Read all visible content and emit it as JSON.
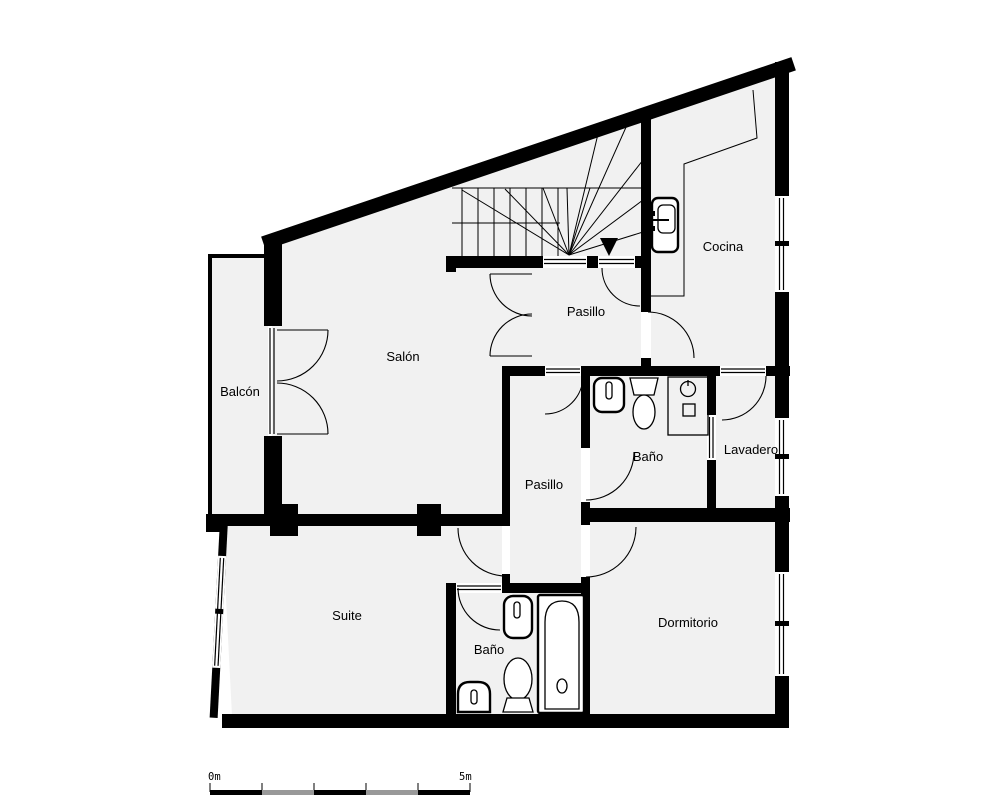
{
  "plan": {
    "rooms": {
      "balcon": {
        "label": "Balcón"
      },
      "salon": {
        "label": "Salón"
      },
      "pasillo_superior": {
        "label": "Pasillo"
      },
      "cocina": {
        "label": "Cocina"
      },
      "bano_principal": {
        "label": "Baño"
      },
      "lavadero": {
        "label": "Lavadero"
      },
      "pasillo_inferior": {
        "label": "Pasillo"
      },
      "suite": {
        "label": "Suite"
      },
      "bano_suite": {
        "label": "Baño"
      },
      "dormitorio": {
        "label": "Dormitorio"
      }
    },
    "scale_bar": {
      "start_label": "0m",
      "end_label": "5m"
    },
    "colors": {
      "wall": "#000000",
      "floor": "#f1f1f1",
      "background": "#ffffff",
      "scale_alt_gray": "#999999"
    },
    "fixtures": [
      "stairs",
      "stairs-direction-arrow",
      "kitchen-counter",
      "kitchen-sink",
      "bathroom-sink",
      "toilet",
      "washing-machine",
      "bidet",
      "bathtub"
    ]
  }
}
